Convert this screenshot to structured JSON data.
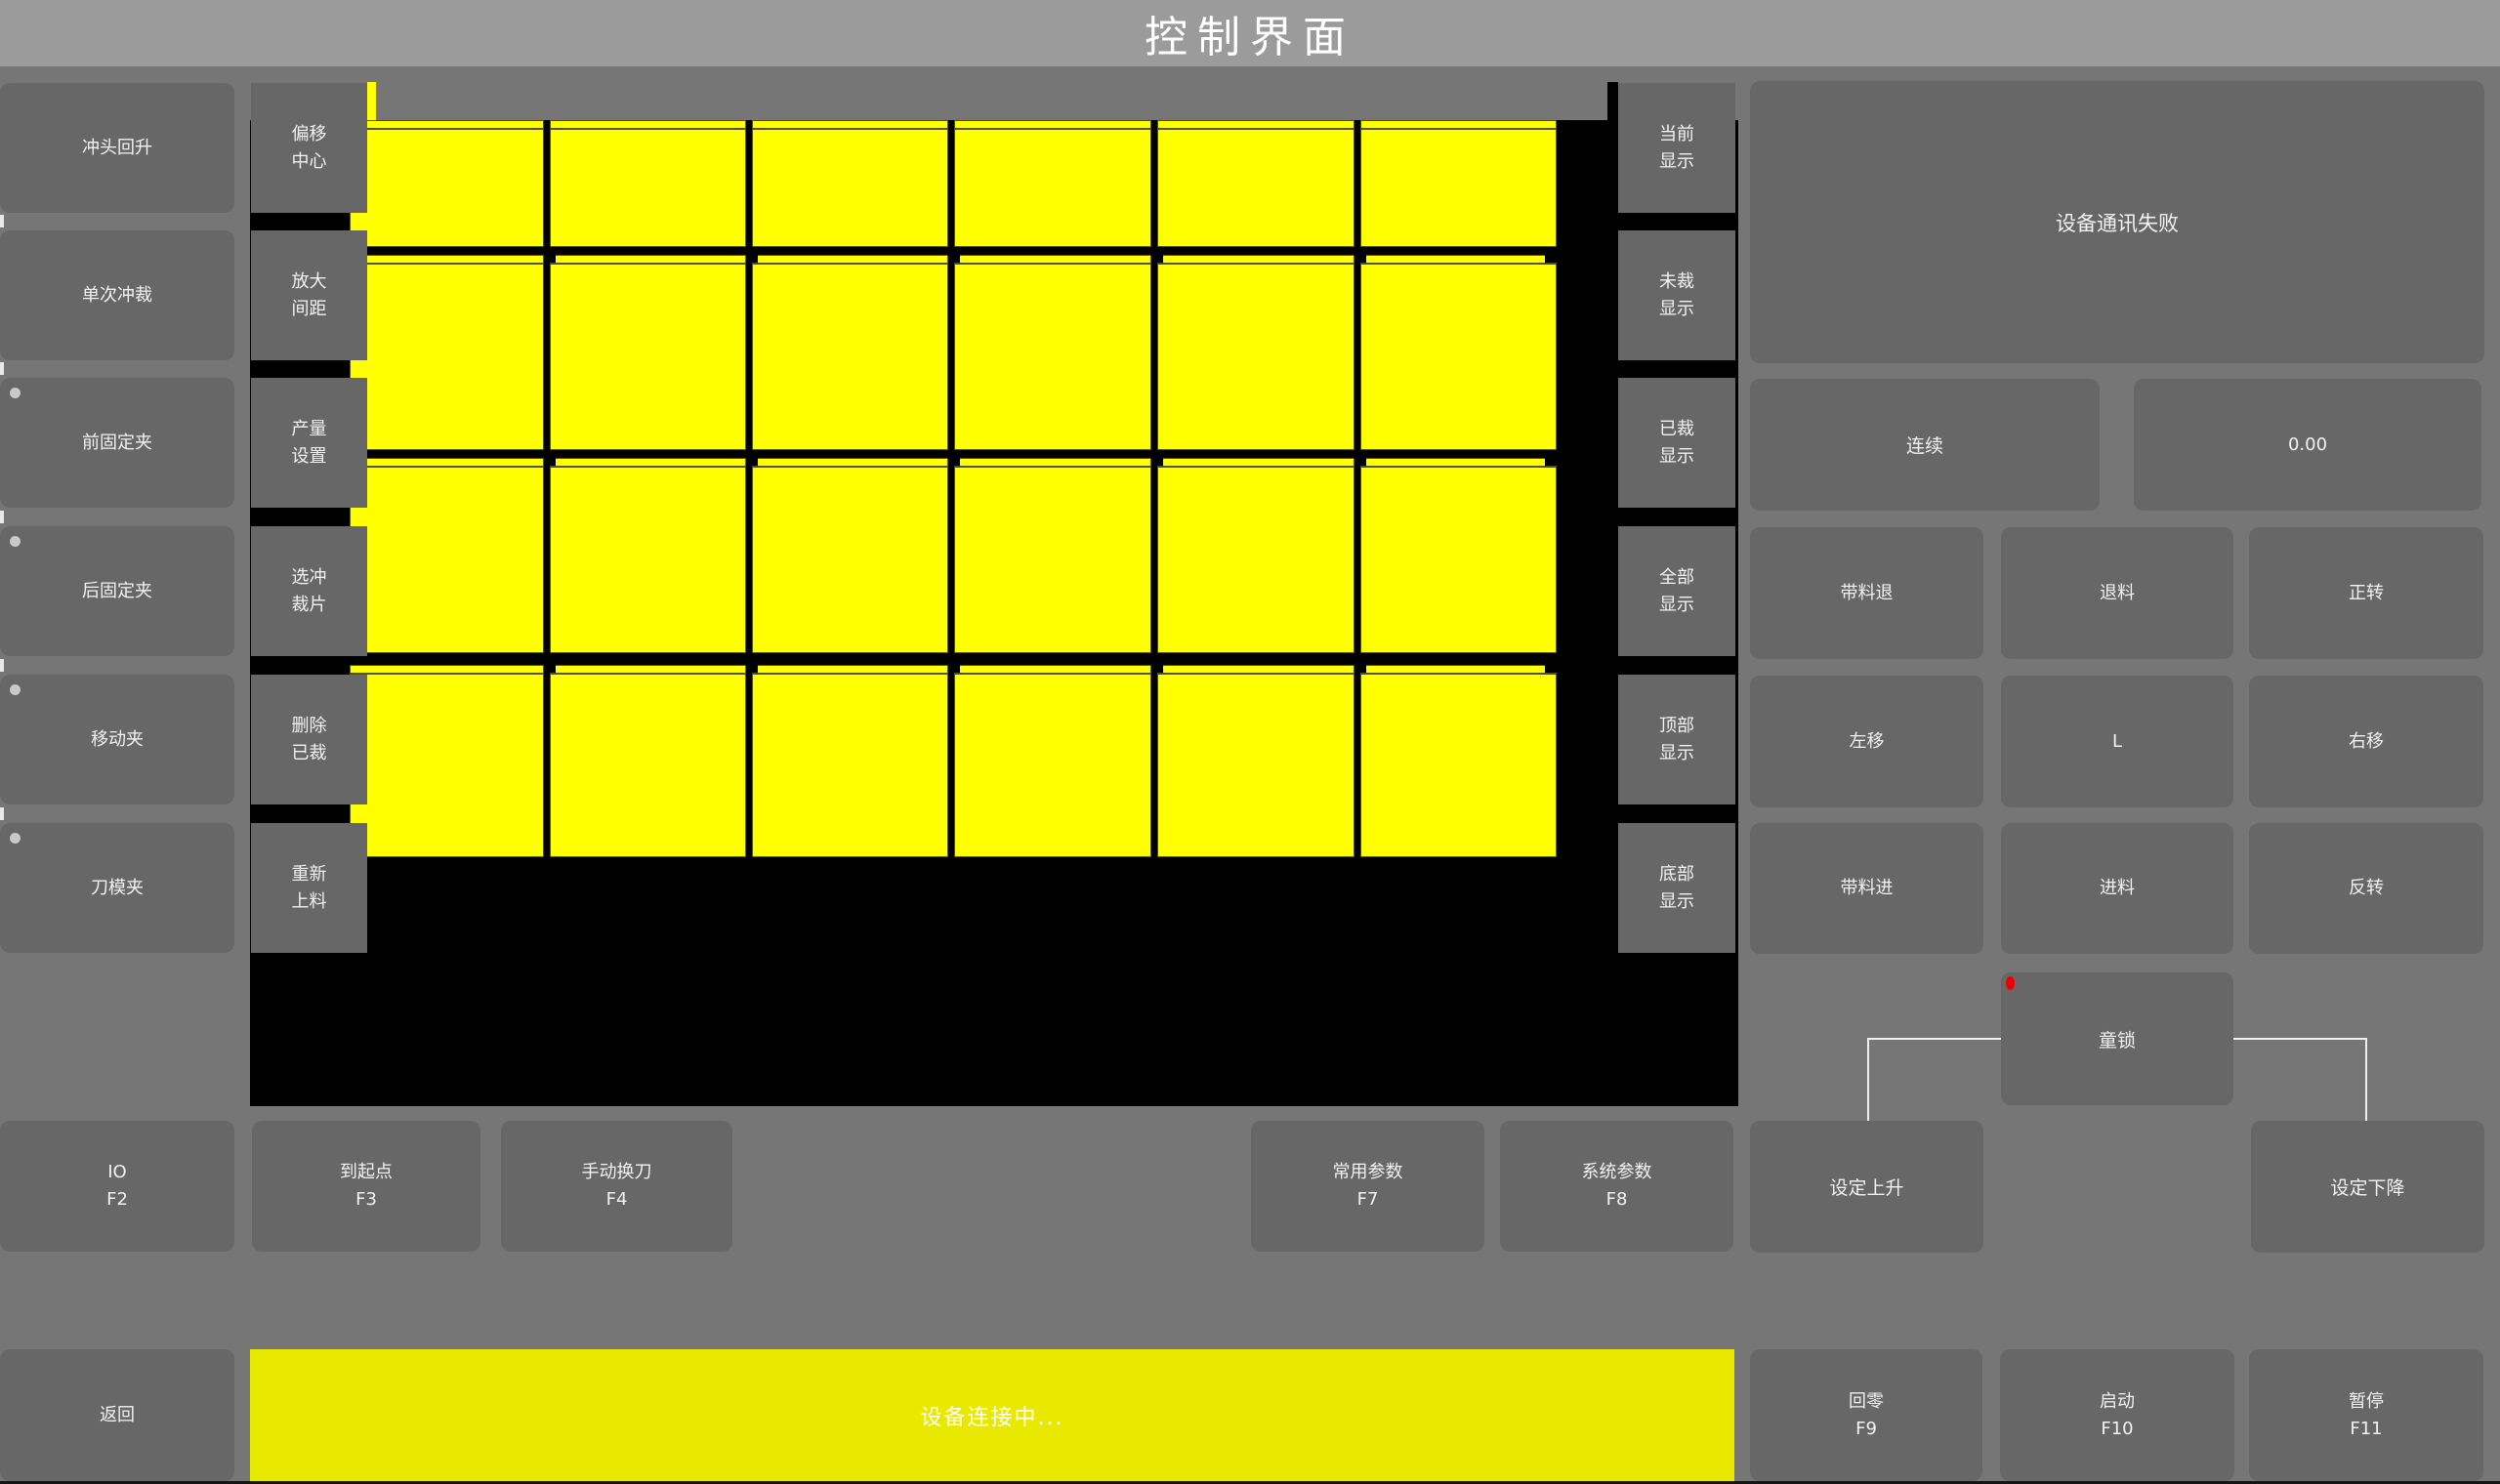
{
  "title": "控制界面",
  "colors": {
    "piece_yellow": "#ffff00",
    "statusbar_yellow": "#e9e900",
    "alert_dot_red": "#ee0000",
    "canvas_black": "#000000",
    "button_gray": "#676767",
    "background_gray": "#767676",
    "titlebar_gray": "#9b9b9b"
  },
  "left_buttons": [
    {
      "label": "冲头回升",
      "dot": false
    },
    {
      "label": "单次冲裁",
      "dot": false
    },
    {
      "label": "前固定夹",
      "dot": true
    },
    {
      "label": "后固定夹",
      "dot": true
    },
    {
      "label": "移动夹",
      "dot": true
    },
    {
      "label": "刀模夹",
      "dot": true
    }
  ],
  "tool_buttons": [
    {
      "line1": "偏移",
      "line2": "中心"
    },
    {
      "line1": "放大",
      "line2": "间距"
    },
    {
      "line1": "产量",
      "line2": "设置"
    },
    {
      "line1": "选冲",
      "line2": "裁片"
    },
    {
      "line1": "删除",
      "line2": "已裁"
    },
    {
      "line1": "重新",
      "line2": "上料"
    }
  ],
  "display_buttons": [
    {
      "line1": "当前",
      "line2": "显示"
    },
    {
      "line1": "未裁",
      "line2": "显示"
    },
    {
      "line1": "已裁",
      "line2": "显示"
    },
    {
      "line1": "全部",
      "line2": "显示"
    },
    {
      "line1": "顶部",
      "line2": "显示"
    },
    {
      "line1": "底部",
      "line2": "显示"
    }
  ],
  "pieces_grid": {
    "columns": 6,
    "rows": 4,
    "piece_color": "#ffff00",
    "state": "all pieces uncut (yellow)"
  },
  "right_panel": {
    "message": "设备通讯失败",
    "mode_label": "连续",
    "value": "0.00",
    "jog_buttons": [
      [
        "带料退",
        "退料",
        "正转"
      ],
      [
        "左移",
        "L",
        "右移"
      ],
      [
        "带料进",
        "进料",
        "反转"
      ]
    ],
    "child_lock_label": "童锁",
    "set_up_label": "设定上升",
    "set_down_label": "设定下降"
  },
  "function_keys": [
    {
      "label": "IO",
      "key": "F2"
    },
    {
      "label": "到起点",
      "key": "F3"
    },
    {
      "label": "手动换刀",
      "key": "F4"
    },
    {
      "label": "常用参数",
      "key": "F7"
    },
    {
      "label": "系统参数",
      "key": "F8"
    }
  ],
  "bottom_bar": {
    "back_label": "返回",
    "status_text": "设备连接中...",
    "keys": [
      {
        "label": "回零",
        "key": "F9"
      },
      {
        "label": "启动",
        "key": "F10"
      },
      {
        "label": "暂停",
        "key": "F11"
      }
    ]
  }
}
